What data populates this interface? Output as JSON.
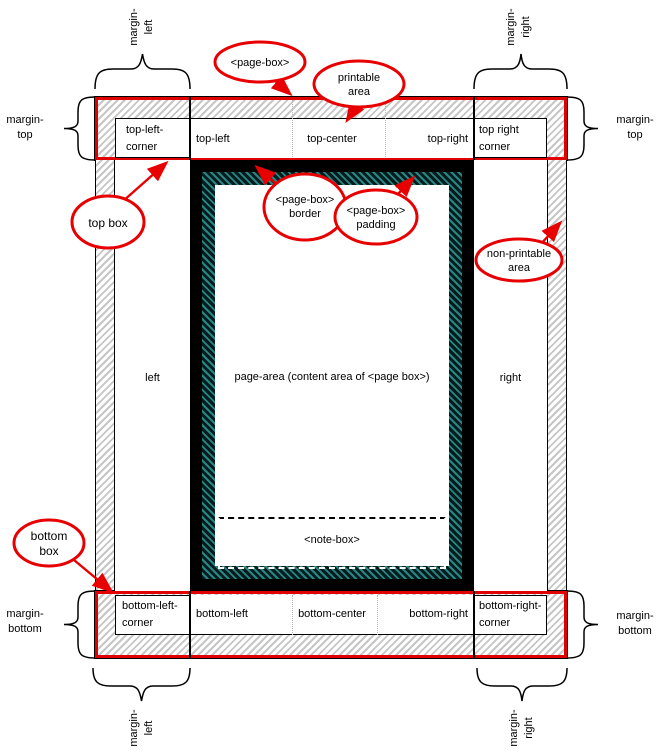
{
  "diagram": {
    "top_band": {
      "corner_left": [
        "top-left-",
        "corner"
      ],
      "left": "top-left",
      "center": "top-center",
      "right": "top-right",
      "corner_right": [
        "top right",
        "corner"
      ]
    },
    "bottom_band": {
      "corner_left": [
        "bottom-left-",
        "corner"
      ],
      "left": "bottom-left",
      "center": "bottom-center",
      "right": "bottom-right",
      "corner_right": [
        "bottom-right-",
        "corner"
      ]
    },
    "side_left": "left",
    "side_right": "right",
    "page_area": "page-area (content area of <page box>)",
    "note_box": "<note-box>"
  },
  "callouts": {
    "page_box": [
      "<page-box>"
    ],
    "printable_area": [
      "printable",
      "area"
    ],
    "top_box": [
      "top box"
    ],
    "page_box_border": [
      "<page-box>",
      "border"
    ],
    "page_box_padding": [
      "<page-box>",
      "padding"
    ],
    "non_printable_area": [
      "non-printable",
      "area"
    ],
    "bottom_box": [
      "bottom",
      "box"
    ]
  },
  "margins": {
    "top_left_rot": [
      "margin-",
      "left"
    ],
    "top_right_rot": [
      "margin-",
      "right"
    ],
    "left_top": [
      "margin-",
      "top"
    ],
    "right_top": [
      "margin-",
      "top"
    ],
    "left_bottom": [
      "margin-",
      "bottom"
    ],
    "right_bottom": [
      "margin-",
      "bottom"
    ],
    "bottom_left_rot": [
      "margin-",
      "left"
    ],
    "bottom_right_rot": [
      "margin-",
      "right"
    ]
  },
  "colors": {
    "accent_red": "#e10000",
    "padding_teal": "#2b8585",
    "hatch_gray": "#c6c6c6",
    "border_black": "#000000"
  }
}
